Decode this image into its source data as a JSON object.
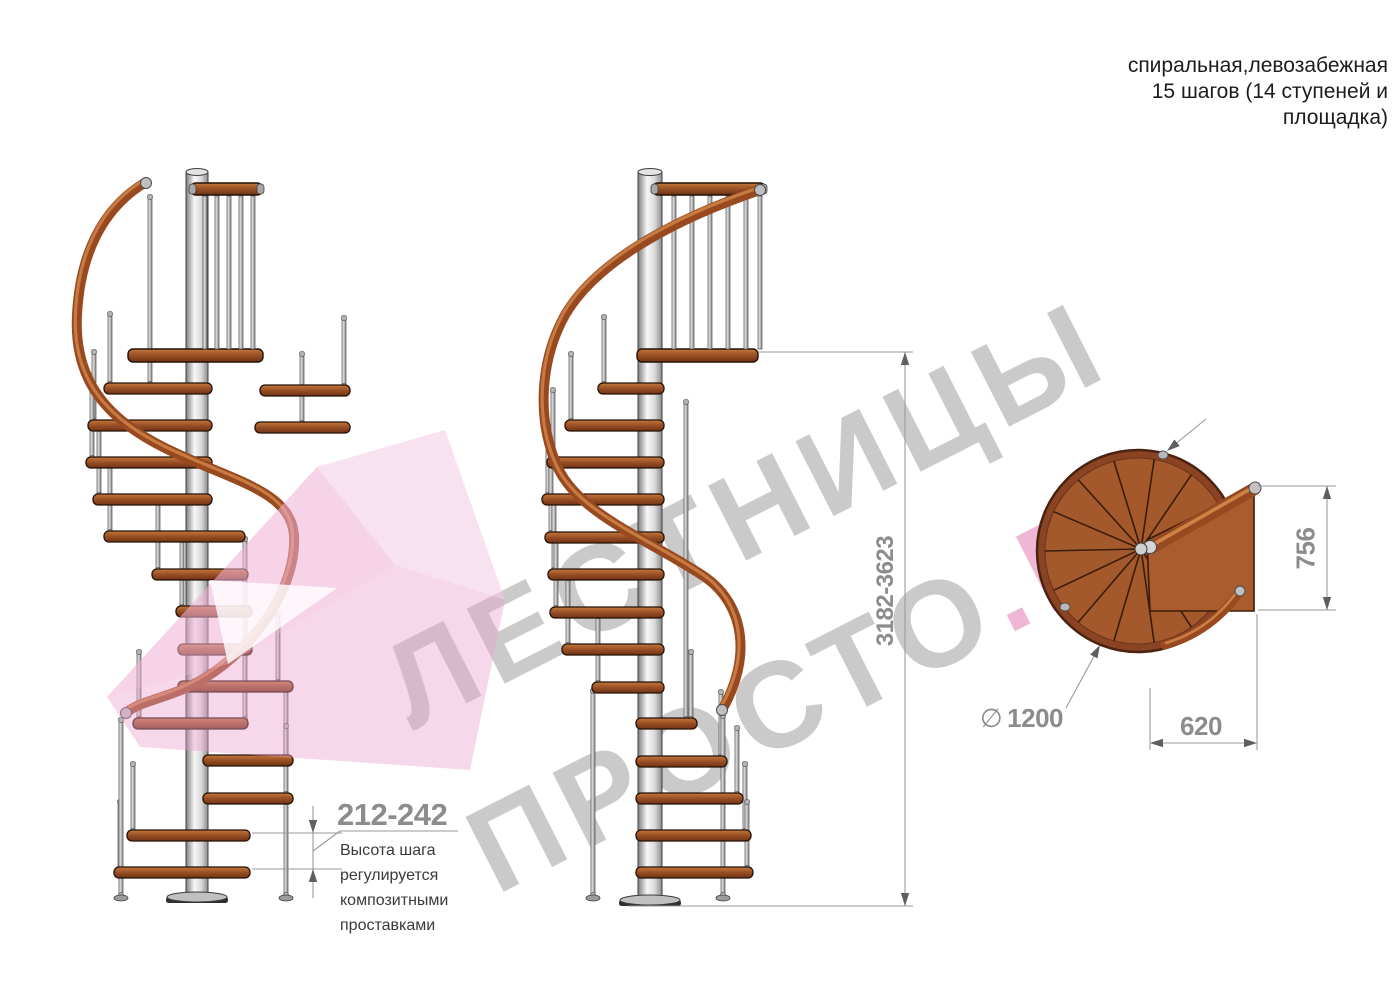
{
  "header": {
    "title_lines": [
      "спиральная,левозабежная",
      "15 шагов (14 ступеней и",
      "площадка)"
    ]
  },
  "watermark": {
    "line1": "ЛЕСТНИЦЫ",
    "line2_main": "ПРОСТО",
    "line2_accent": ".РУ",
    "text_color": "#cacaca",
    "accent_color": "#f0b6d5",
    "arrow_color": "#ec9fcb"
  },
  "dimensions": {
    "step_height": {
      "value": "212-242",
      "note_lines": [
        "Высота шага",
        "регулируется",
        "композитными",
        "проставками"
      ]
    },
    "total_height": {
      "value": "3182-3623"
    },
    "platform_depth": {
      "value": "756"
    },
    "platform_width": {
      "value": "620"
    },
    "diameter": {
      "symbol": "∅",
      "value": "1200"
    }
  },
  "colors": {
    "wood_light": "#c4793f",
    "wood_mid": "#9c5226",
    "wood_dark": "#6f3314",
    "rail": "#98491f",
    "rail_highlight": "#cc7f45",
    "metal_light": "#f7f7f7",
    "metal_mid": "#b9b9b9",
    "dim_text": "#8c8c8c",
    "dim_line": "#9a9a9a",
    "note_text": "#3a3a3a",
    "title_text": "#1c1c1c"
  }
}
